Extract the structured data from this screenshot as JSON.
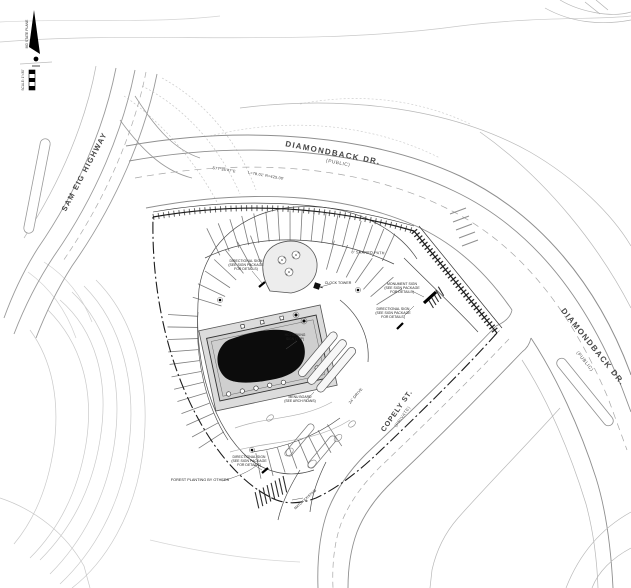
{
  "compass": {
    "plane_label": "MD STATE PLANE",
    "scale_label": "SCALE: 1\"=30'"
  },
  "roads": {
    "highway": {
      "name": "SAM EIG HIGHWAY"
    },
    "diamondback_top": {
      "name": "DIAMONDBACK DR.",
      "designation": "(PUBLIC)"
    },
    "diamondback_right": {
      "name": "DIAMONDBACK DR.",
      "designation": "(PUBLIC)"
    },
    "copely": {
      "name": "COPELY ST.",
      "designation": "(PRIVATE)"
    }
  },
  "survey": {
    "bearing": "S77°35'47\"E",
    "curve_data": "L=78.01'  R=425.00'",
    "drive_width": "24' DRIVE"
  },
  "annotations": {
    "shared_path": "8' SHARED PATH",
    "monument_sign": [
      "MONUMENT SIGN",
      "(SEE SIGN PACKAGE",
      "FOR DETAILS)"
    ],
    "directional_sign": [
      "DIRECTIONAL SIGN",
      "(SEE SIGN PACKAGE",
      "FOR DETAILS)"
    ],
    "clock_tower": "CLOCK TOWER",
    "forest_planting": "FOREST PLANTING BY OTHERS",
    "menu_board": [
      "MENU BOARD",
      "(SEE ARCH PLANS)"
    ],
    "hc_sign": [
      "HC PARKING",
      "SIGN (TYP)"
    ],
    "match_existing": "MATCH EXISTING"
  },
  "colors": {
    "existing_line": "#c6c6c6",
    "road_line": "#8f8f8f",
    "site_line": "#1c1c1c",
    "building_fill": "#cfcfcf",
    "roof_blob": "#0c0c0c"
  }
}
